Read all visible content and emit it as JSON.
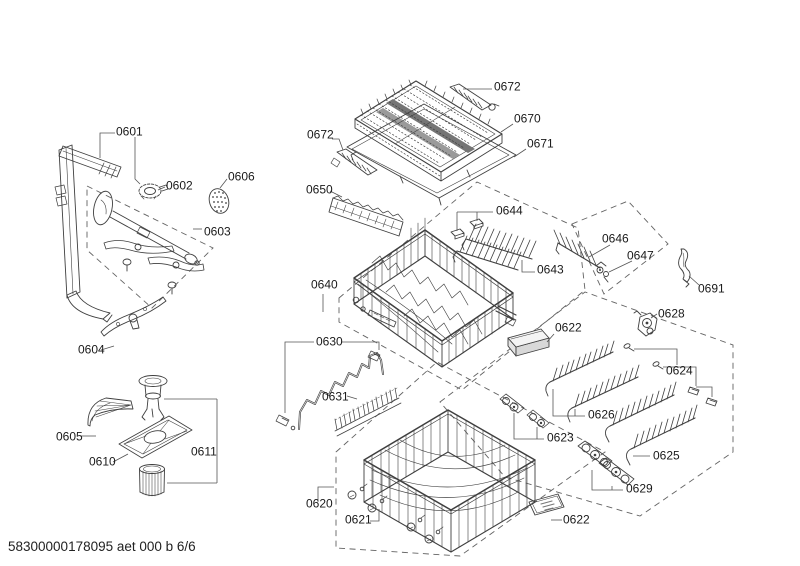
{
  "page": {
    "footer_text": "58300000178095 aet 000 b 6/6",
    "background_color": "#ffffff",
    "line_color": "#3f3f3f",
    "dash_color": "#636363",
    "label_color": "#1a1a1a",
    "shade_color": "#757575"
  },
  "labels": [
    {
      "text": "0601"
    },
    {
      "text": "0602"
    },
    {
      "text": "0606"
    },
    {
      "text": "0603"
    },
    {
      "text": "0604"
    },
    {
      "text": "0605"
    },
    {
      "text": "0610"
    },
    {
      "text": "0611"
    },
    {
      "text": "0672"
    },
    {
      "text": "0672"
    },
    {
      "text": "0670"
    },
    {
      "text": "0671"
    },
    {
      "text": "0650"
    },
    {
      "text": "0640"
    },
    {
      "text": "0644"
    },
    {
      "text": "0643"
    },
    {
      "text": "0646"
    },
    {
      "text": "0647"
    },
    {
      "text": "0691"
    },
    {
      "text": "0628"
    },
    {
      "text": "0622"
    },
    {
      "text": "0630"
    },
    {
      "text": "0631"
    },
    {
      "text": "0624"
    },
    {
      "text": "0626"
    },
    {
      "text": "0623"
    },
    {
      "text": "0625"
    },
    {
      "text": "0629"
    },
    {
      "text": "0620"
    },
    {
      "text": "0621"
    },
    {
      "text": "0622"
    }
  ]
}
